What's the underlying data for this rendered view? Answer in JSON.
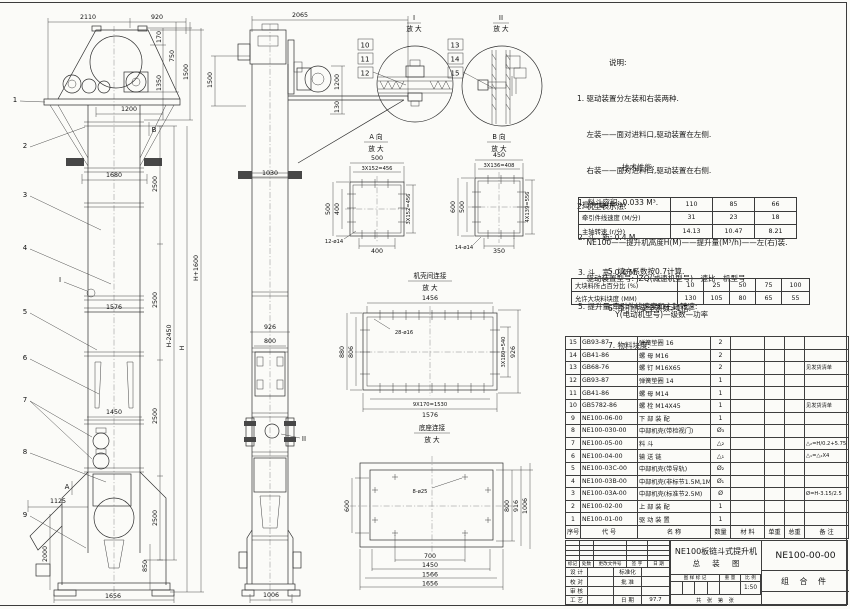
{
  "notes": {
    "heading": "说明:",
    "lines": [
      "1. 驱动装置分左装和右装两种.",
      "    左装——面对进料口,驱动装置在左侧.",
      "    右装——面对进料口,驱动装置在右侧.",
      "2. 机型表示法:",
      "    NE100——提升机高度H(M)——提升量(M³/h)——左(右)装.",
      "    驱动装置型号: JZQ(减速机型号)—速比—机型号",
      "                Y(电动机型号)—级数—功率"
    ]
  },
  "specs": {
    "heading": "技术性能:",
    "lines": [
      "1. 料斗容积: 0.033 M³.",
      "2. 斗   距: 0.4 M.",
      "3. 斗   宽: 0.4 M.",
      "5. 提升量,牵引件线速度和主轴转速:"
    ],
    "lines2": [
      "5. 填充系数按0.7计算.",
      "6. 牵引件安全系数>1倍.",
      "7. 物料块度:"
    ]
  },
  "perf_table": {
    "rows": [
      {
        "label": "提 升 量  (M³/h)",
        "c1": "110",
        "c2": "85",
        "c3": "66"
      },
      {
        "label": "牵引件线速度 (M/分)",
        "c1": "31",
        "c2": "23",
        "c3": "18"
      },
      {
        "label": "主轴转速 (r/分)",
        "c1": "14.13",
        "c2": "10.47",
        "c3": "8.21"
      }
    ]
  },
  "lump_table": {
    "rows": [
      {
        "label": "大块料所占百分比 (%)",
        "c1": "10",
        "c2": "25",
        "c3": "50",
        "c4": "75",
        "c5": "100"
      },
      {
        "label": "允许大块料块度 (MM)",
        "c1": "130",
        "c2": "105",
        "c3": "80",
        "c4": "65",
        "c5": "55"
      }
    ]
  },
  "bom": {
    "headers": [
      "序号",
      "代  号",
      "名    称",
      "数量",
      "材  料",
      "单重",
      "总重",
      "备  注"
    ],
    "rows": [
      {
        "no": "15",
        "code": "GB93-87",
        "name": "弹簧垫圈  16",
        "qty": "2",
        "note": ""
      },
      {
        "no": "14",
        "code": "GB41-86",
        "name": "螺  母  M16",
        "qty": "2",
        "note": ""
      },
      {
        "no": "13",
        "code": "GB68-76",
        "name": "螺  钉  M16X65",
        "qty": "2",
        "note": "见发货清单"
      },
      {
        "no": "12",
        "code": "GB93-87",
        "name": "弹簧垫圈  14",
        "qty": "1",
        "note": ""
      },
      {
        "no": "11",
        "code": "GB41-86",
        "name": "螺  母  M14",
        "qty": "1",
        "note": ""
      },
      {
        "no": "10",
        "code": "GB5782-86",
        "name": "螺  栓  M14X45",
        "qty": "1",
        "note": "见发货清单"
      },
      {
        "no": "9",
        "code": "NE100-06-00",
        "name": "下 部 装 配",
        "qty": "1",
        "note": ""
      },
      {
        "no": "8",
        "code": "NE100-030-00",
        "name": "中部机壳(带检视门)",
        "qty": "Ø₃",
        "note": ""
      },
      {
        "no": "7",
        "code": "NE100-05-00",
        "name": "料  斗",
        "qty": "△₂",
        "note": "△₂=H/0.2+5.75"
      },
      {
        "no": "6",
        "code": "NE100-04-00",
        "name": "输 送 链",
        "qty": "△₁",
        "note": "△₁=△₂X4"
      },
      {
        "no": "5",
        "code": "NE100-03C-00",
        "name": "中部机壳(带导轨)",
        "qty": "Ø₂",
        "note": ""
      },
      {
        "no": "4",
        "code": "NE100-03B-00",
        "name": "中部机壳(非标节1.5M,1M)",
        "qty": "Ø₁",
        "note": ""
      },
      {
        "no": "3",
        "code": "NE100-03A-00",
        "name": "中部机壳(标准节2.5M)",
        "qty": "Ø",
        "note": "Ø=H-3.15/2.5"
      },
      {
        "no": "2",
        "code": "NE100-02-00",
        "name": "上 部 装 配",
        "qty": "1",
        "note": ""
      },
      {
        "no": "1",
        "code": "NE100-01-00",
        "name": "驱 动 装 置",
        "qty": "1",
        "note": ""
      }
    ]
  },
  "titleblock": {
    "product": "NE100板链斗式提升机",
    "drawing_title": "总  装  图",
    "drawing_no": "NE100-00-00",
    "part_class": "组 合 件",
    "rev_headers": [
      "标记",
      "处数",
      "更改文件号",
      "签 字",
      "日 期"
    ],
    "r_design": "设 计",
    "r_check": "校 对",
    "r_review": "审 核",
    "r_process": "工 艺",
    "r_std": "标准化",
    "r_approve": "批 准",
    "r_date": "日 期",
    "date_val": "97.7",
    "stamp_label": "图 样 标 记",
    "weight_label": "重 量",
    "scale_label": "比 例",
    "scale": "1:50",
    "sheets": "共  张  第  张"
  },
  "labels": {
    "mag": "放 大",
    "d1": "I",
    "d2": "II",
    "va": "A 向",
    "vb": "B 向",
    "shell": "机壳间连接",
    "base": "底座连接"
  },
  "markers": {
    "a": "A",
    "b": "B"
  },
  "balloons": [
    "1",
    "2",
    "3",
    "4",
    "5",
    "6",
    "7",
    "8",
    "9",
    "10",
    "11",
    "12",
    "13",
    "14",
    "15"
  ],
  "dims": {
    "fv_top1": "2110",
    "fv_top2": "920",
    "fv_r170": "170",
    "fv_r750": "750",
    "fv_r1350": "1350",
    "fv_r1500": "1500",
    "fv_1200": "1200",
    "fv_1680": "1680",
    "fv_1576": "1576",
    "fv_1450": "1450",
    "fv_2500": "2500",
    "fv_h2450": "H-2450",
    "fv_h": "H",
    "fv_h1600": "H+1600",
    "fv_1125": "1125",
    "fv_2000": "2000",
    "fv_850": "850",
    "fv_1656": "1656",
    "sv_2065": "2065",
    "sv_1500": "1500",
    "sv_1200": "1200",
    "sv_130": "130",
    "sv_1030": "1030",
    "sv_926": "926",
    "sv_800": "800",
    "sv_1006": "1006",
    "va_500t": "500",
    "va_456t": "3X152=456",
    "va_500l": "500",
    "va_400l": "400",
    "va_456r": "3X152=456",
    "va_400b": "400",
    "va_holes": "12-ø14",
    "vb_450": "450",
    "vb_408": "3X136=408",
    "vb_600": "600",
    "vb_500": "500",
    "vb_556r": "4X139=556",
    "vb_350": "350",
    "vb_holes": "14-ø14",
    "sh_1456": "1456",
    "sh_holes": "28-ø16",
    "sh_880": "880",
    "sh_806": "806",
    "sh_540": "3X180=540",
    "sh_926": "926",
    "sh_1530": "9X170=1530",
    "sh_1576": "1576",
    "bs_holes": "8-ø25",
    "bs_600": "600",
    "bs_800": "800",
    "bs_916": "916",
    "bs_1006": "1006",
    "bs_700": "700",
    "bs_1450": "1450",
    "bs_1566": "1566",
    "bs_1656": "1656"
  }
}
